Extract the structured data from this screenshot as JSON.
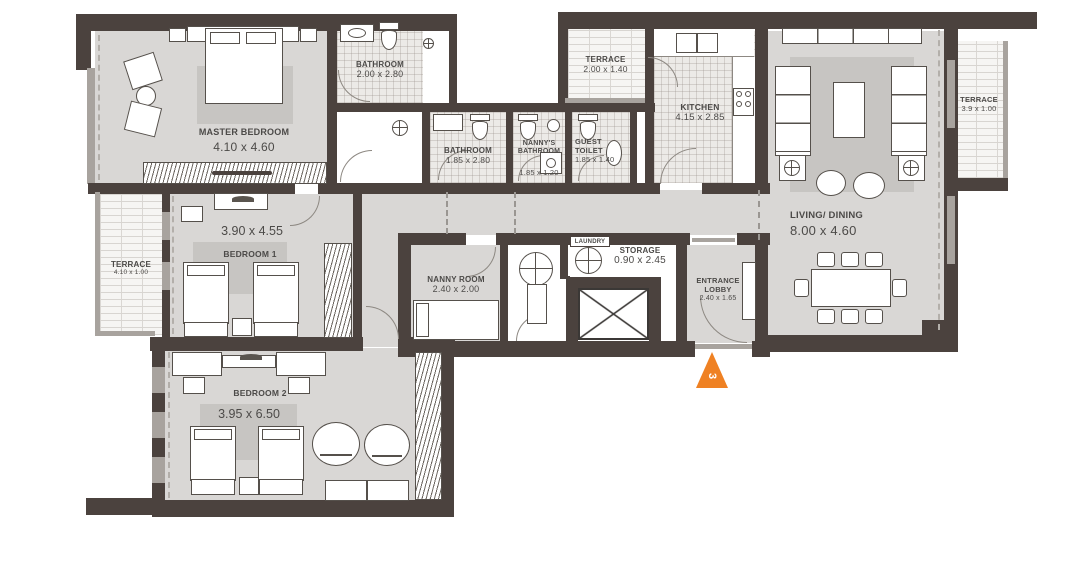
{
  "plan": {
    "marker_label": "3",
    "colors": {
      "wall": "#4b423e",
      "room_fill": "#d9d7d5",
      "tile_fill": "#eceae7",
      "terrace_fill": "#f6f5f3",
      "accent_orange": "#ef8123"
    },
    "icons": {
      "unit_marker": "orange-triangle",
      "elevator": "x-crossed-box",
      "laundry_machine": "circle-with-cross"
    },
    "rooms": {
      "master_bedroom": {
        "name": "MASTER BEDROOM",
        "dims": "4.10 x 4.60"
      },
      "bathroom_master": {
        "name": "BATHROOM",
        "dims": "2.00 x 2.80"
      },
      "terrace_top": {
        "name": "TERRACE",
        "dims": "2.00 x 1.40"
      },
      "kitchen": {
        "name": "KITCHEN",
        "dims": "4.15 x 2.85"
      },
      "living_dining": {
        "name": "LIVING/ DINING",
        "dims": "8.00 x 4.60"
      },
      "terrace_right": {
        "name": "TERRACE",
        "dims": "3.9 x 1.00"
      },
      "terrace_left": {
        "name": "TERRACE",
        "dims": "4.10 x 1.00"
      },
      "bedroom_1": {
        "name": "BEDROOM 1",
        "dims": "3.90 x 4.55"
      },
      "bathroom_shared": {
        "name": "BATHROOM",
        "dims": "1.85 x 2.80"
      },
      "nannys_bathroom": {
        "name": "NANNY'S BATHROOM",
        "dims": "1.85 x 1.20"
      },
      "guest_toilet": {
        "name": "GUEST TOILET",
        "dims": "1.85 x 1.40"
      },
      "nanny_room": {
        "name": "NANNY ROOM",
        "dims": "2.40 x 2.00"
      },
      "laundry": {
        "name": "LAUNDRY"
      },
      "storage": {
        "name": "STORAGE",
        "dims": "0.90 x 2.45"
      },
      "entrance_lobby": {
        "name": "ENTRANCE LOBBY",
        "dims": "2.40 x 1.65"
      },
      "bedroom_2": {
        "name": "BEDROOM 2",
        "dims": "3.95 x 6.50"
      }
    }
  }
}
